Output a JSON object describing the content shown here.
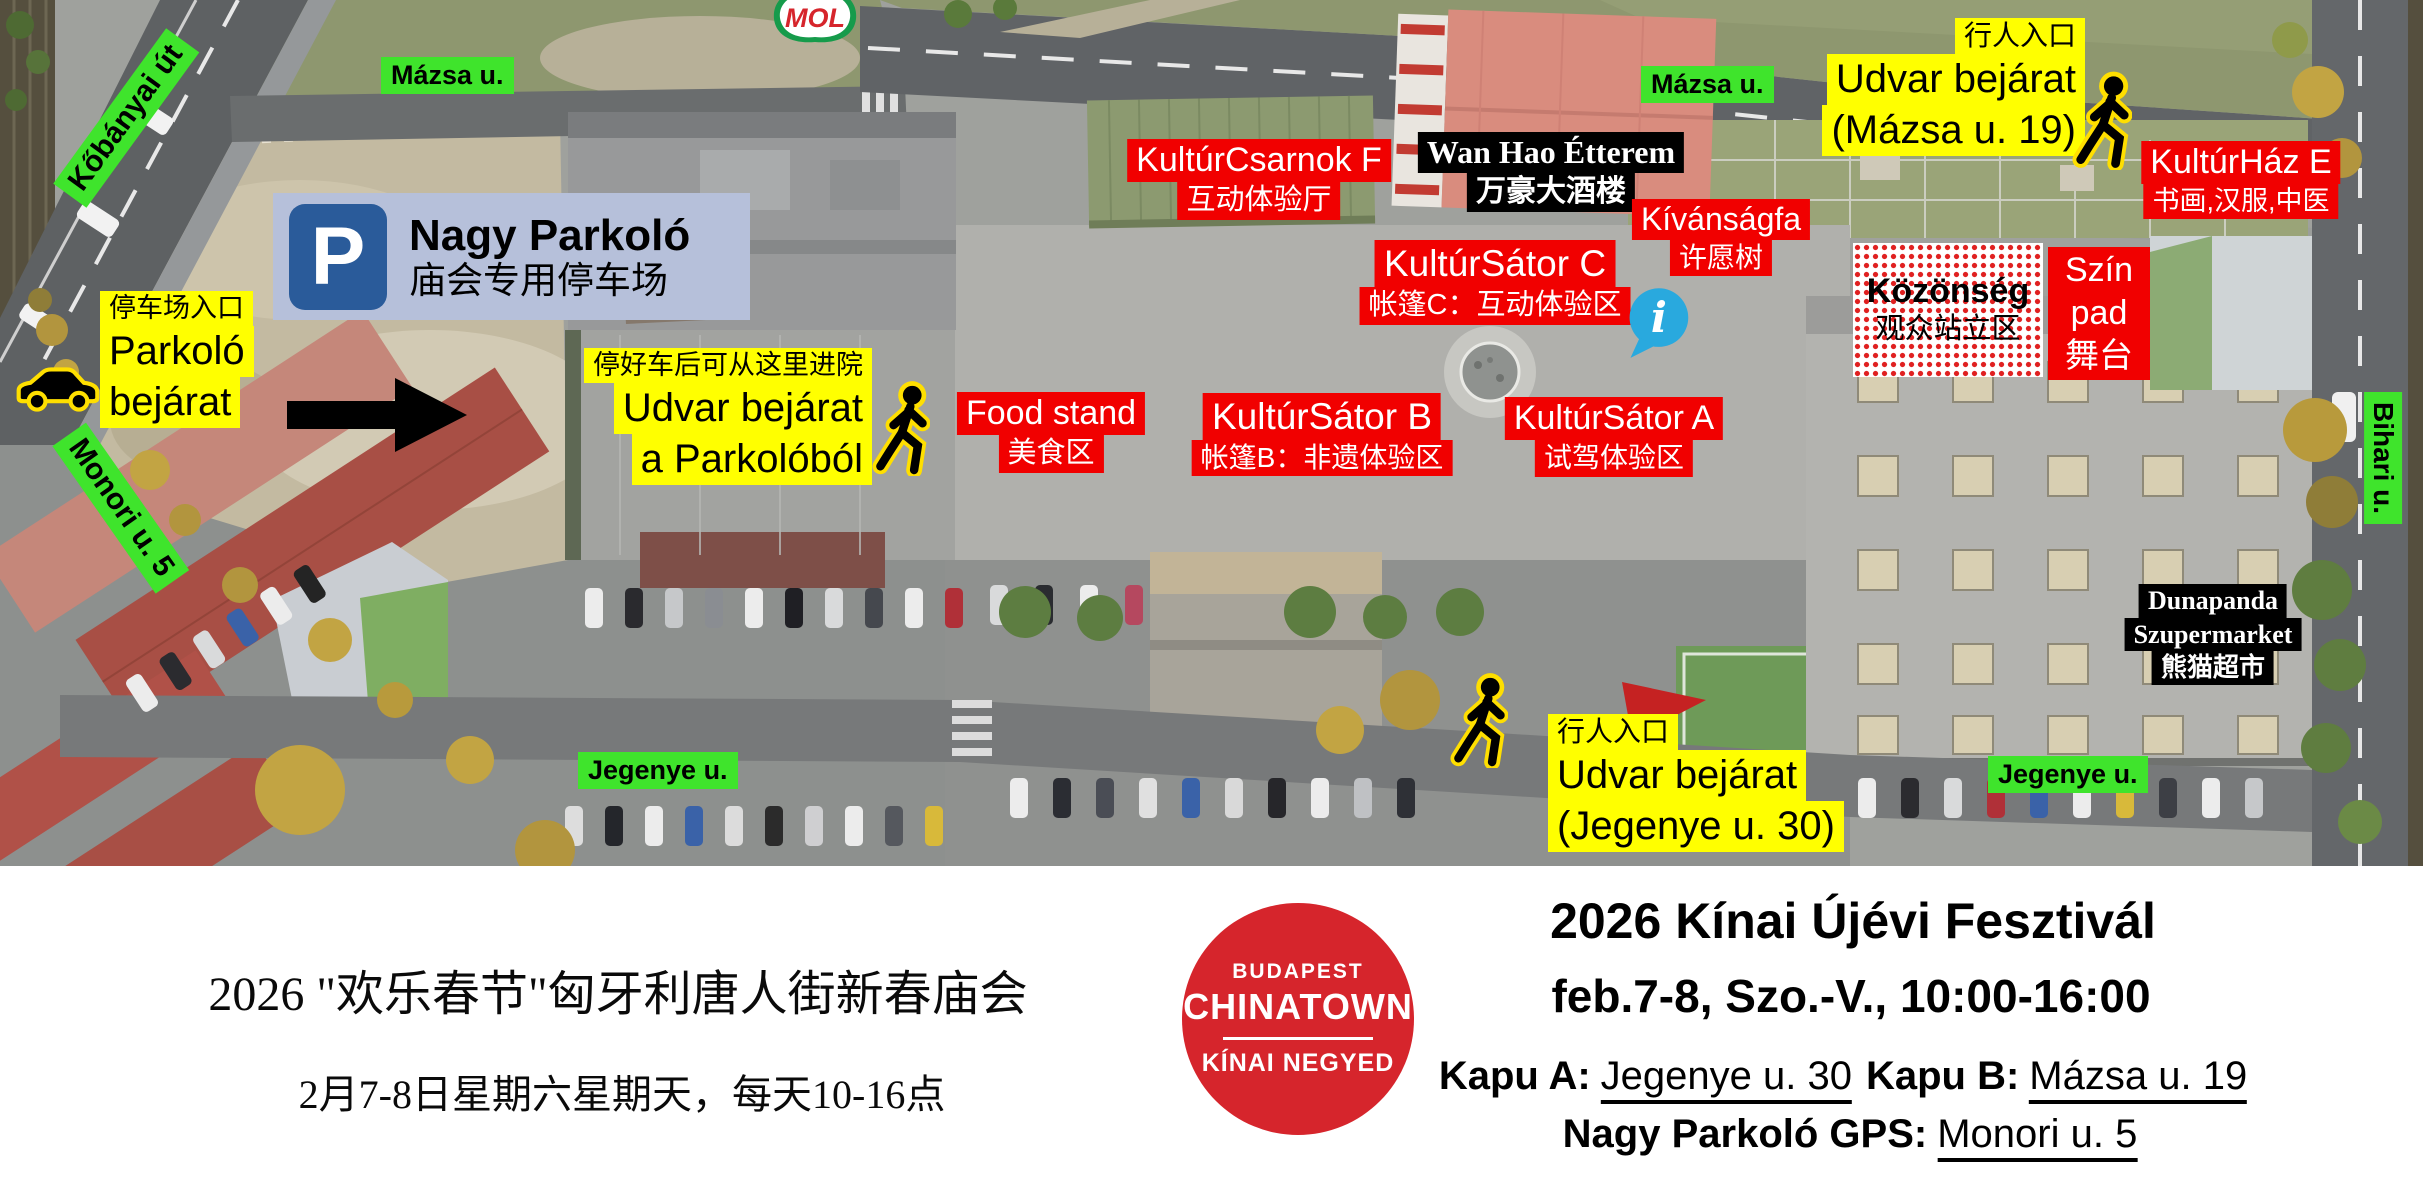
{
  "colors": {
    "street_label_bg": "#3fe42c",
    "entrance_label_bg": "#ffff00",
    "venue_label_bg": "#f10000",
    "black_label_bg": "#000000",
    "parking_sign_bg": "#b6c0da",
    "parking_icon_blue": "#2a5b9a",
    "info_icon_blue": "#29a9de",
    "logo_red": "#d6252c"
  },
  "map": {
    "mol": "MOL",
    "icons": {
      "info": "i"
    },
    "streets": {
      "kobanyai": "Kőbányai út",
      "mazsa_left": "Mázsa u.",
      "mazsa_right": "Mázsa u.",
      "monori": "Monori u. 5",
      "jegenye_left": "Jegenye u.",
      "jegenye_right": "Jegenye u.",
      "bihari": "Bihari u."
    },
    "parking_sign": {
      "p": "P",
      "title": "Nagy Parkoló",
      "subtitle": "庙会专用停车场"
    },
    "parking_entrance": {
      "zh": "停车场入口",
      "line1": "Parkoló",
      "line2": "bejárat"
    },
    "courtyard_from_parking": {
      "zh": "停好车后可从这里进院",
      "line1": "Udvar bejárat",
      "line2": "a Parkolóból"
    },
    "entrance_mazsa": {
      "zh": "行人入口",
      "line1": "Udvar bejárat",
      "line2": "(Mázsa u. 19)"
    },
    "entrance_jegenye": {
      "zh": "行人入口",
      "line1": "Udvar bejárat",
      "line2": "(Jegenye u. 30)"
    },
    "venues": {
      "kulturcsarnok": {
        "name": "KultúrCsarnok F",
        "zh": "互动体验厅"
      },
      "wanhao": {
        "name": "Wan Hao Étterem",
        "zh": "万豪大酒楼"
      },
      "kultursator_c": {
        "name": "KultúrSátor C",
        "zh": "帐篷C：互动体验区"
      },
      "kivansagfa": {
        "name": "Kívánságfa",
        "zh": "许愿树"
      },
      "foodstand": {
        "name": "Food stand",
        "zh": "美食区"
      },
      "kultursator_b": {
        "name": "KultúrSátor B",
        "zh": "帐篷B：非遗体验区"
      },
      "kultursator_a": {
        "name": "KultúrSátor A",
        "zh": "试驾体验区"
      },
      "kulturhaz": {
        "name": "KultúrHáz E",
        "zh": "书画,汉服,中医"
      },
      "szinpad": {
        "line1": "Szín",
        "line2": "pad",
        "zh": "舞台"
      },
      "kozonseg": {
        "name": "Közönség",
        "zh": "观众站立区"
      },
      "dunapanda": {
        "line1": "Dunapanda",
        "line2": "Szupermarket",
        "zh": "熊猫超市"
      }
    }
  },
  "footer": {
    "zh_title": "2026 \"欢乐春节\"匈牙利唐人街新春庙会",
    "zh_schedule": "2月7-8日星期六星期天，每天10-16点",
    "logo": {
      "line1": "BUDAPEST",
      "line2": "CHINATOWN",
      "line3": "KÍNAI NEGYED"
    },
    "hu_title": "2026 Kínai Újévi Fesztivál",
    "hu_schedule": "feb.7-8,  Szo.-V., 10:00-16:00",
    "gate_a_label": "Kapu A:",
    "gate_a_value": "Jegenye u. 30",
    "gate_b_label": "Kapu B:",
    "gate_b_value": "Mázsa u. 19",
    "gps_label": "Nagy Parkoló GPS:",
    "gps_value": "Monori u. 5"
  }
}
